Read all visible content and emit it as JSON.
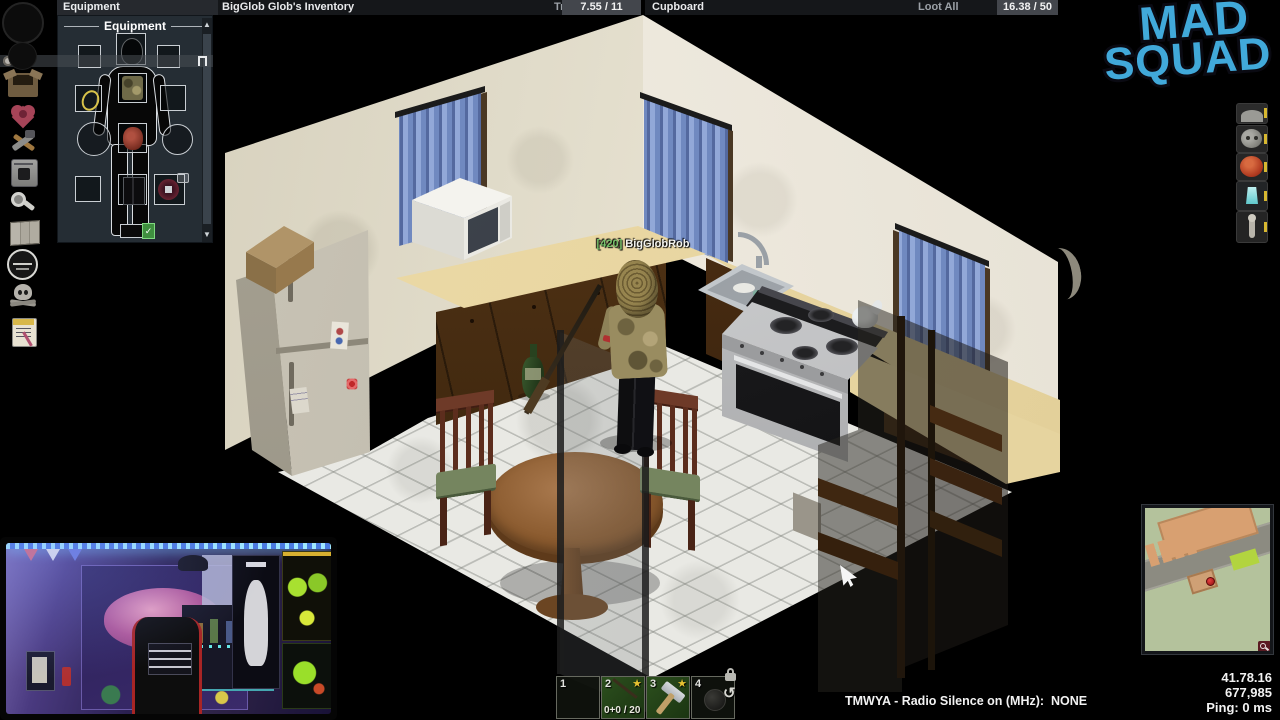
{
  "top_bar": {
    "equipment_tab": "Equipment",
    "inventory_title": "BigGlob Glob's Inventory",
    "transfer_all": "Transfer All",
    "inventory_weight": "7.55 / 11",
    "loot_title": "Cupboard",
    "loot_all": "Loot All",
    "loot_weight": "16.38 / 50"
  },
  "equipment_window": {
    "header": "Equipment"
  },
  "sidebar": {
    "icons": [
      "clock-circle",
      "moodle-circle",
      "inventory-box",
      "health-heart",
      "crafting-tools",
      "furnace",
      "search",
      "map",
      "faction-badge",
      "skull",
      "journal"
    ]
  },
  "right_icons": [
    "gray-face",
    "sloth-face",
    "angry-face",
    "lantern",
    "figure"
  ],
  "logo": {
    "line1": "MAD",
    "line2": "SQUAD",
    "color": "#41a9da"
  },
  "player": {
    "tag": "[420]",
    "name": "BigGlobRob"
  },
  "hotbar": {
    "slots": [
      {
        "num": "1",
        "item": ""
      },
      {
        "num": "2",
        "item": "firearm",
        "favorite": "★",
        "ammo": "0+0 / 20"
      },
      {
        "num": "3",
        "item": "hammer",
        "favorite": "★"
      },
      {
        "num": "4",
        "item": "dark-item"
      }
    ]
  },
  "status": {
    "radio": "TMWYA - Radio Silence on (MHz):  NONE",
    "coordinates": "41.78.16",
    "number": "677,985",
    "ping": "Ping: 0 ms"
  },
  "colors": {
    "curtain_blue": "#7d97c9",
    "counter_tan": "#e9d7a4",
    "cabinet_brown": "#4a2e15",
    "favorite_star": "#e8c231",
    "logo_blue": "#41a9da",
    "minimap_green": "#b4c29c"
  }
}
